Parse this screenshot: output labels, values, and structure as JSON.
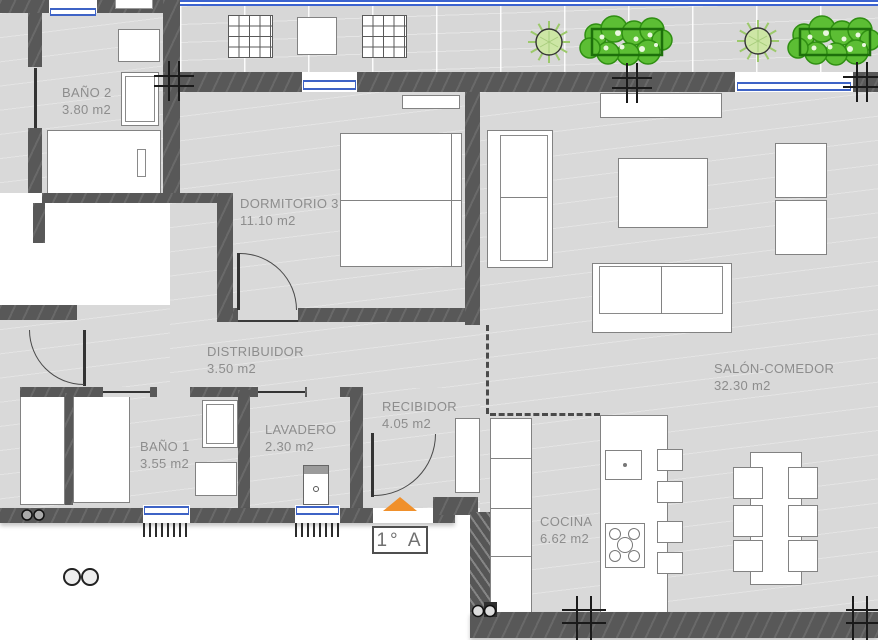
{
  "unit": {
    "label": "1° A"
  },
  "rooms": [
    {
      "id": "bano2",
      "name": "BAÑO 2",
      "area": "3.80 m2"
    },
    {
      "id": "dormitorio3",
      "name": "DORMITORIO 3",
      "area": "11.10 m2"
    },
    {
      "id": "distribuidor",
      "name": "DISTRIBUIDOR",
      "area": "3.50 m2"
    },
    {
      "id": "bano1",
      "name": "BAÑO 1",
      "area": "3.55 m2"
    },
    {
      "id": "lavadero",
      "name": "LAVADERO",
      "area": "2.30 m2"
    },
    {
      "id": "recibidor",
      "name": "RECIBIDOR",
      "area": "4.05 m2"
    },
    {
      "id": "cocina",
      "name": "COCINA",
      "area": "6.62 m2"
    },
    {
      "id": "salon",
      "name": "SALÓN-COMEDOR",
      "area": "32.30 m2"
    }
  ],
  "colors": {
    "wall_gray": "#585858",
    "floor_gray": "#d9d9d9",
    "window_blue": "#3e63c6",
    "entrance_orange": "#f0902b",
    "plant_green": "#5cbe34",
    "label_gray": "#8d8d8d"
  },
  "icons": [
    "plant-icon",
    "hedge-icon",
    "column-mark-icon",
    "drain-icon",
    "entrance-arrow-icon"
  ]
}
